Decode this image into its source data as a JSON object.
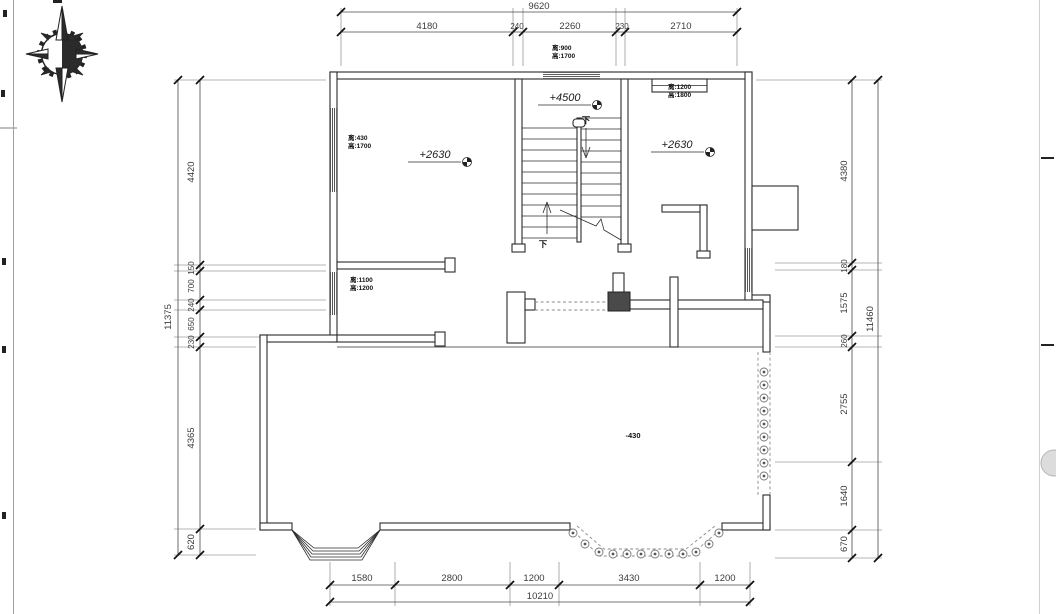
{
  "drawing": {
    "type": "architectural floor plan",
    "compass": "north-compass-rose"
  },
  "dimensions": {
    "top": {
      "total": "9620",
      "segments": [
        "4180",
        "240",
        "2260",
        "230",
        "2710"
      ]
    },
    "left": {
      "total": "11375",
      "segments": [
        "4420",
        "150",
        "700",
        "240",
        "650",
        "230",
        "4365",
        "620"
      ]
    },
    "right": {
      "total": "11460",
      "segments": [
        "4380",
        "180",
        "1575",
        "260",
        "2755",
        "1640",
        "670"
      ]
    },
    "bottom": {
      "total": "10210",
      "segments": [
        "1580",
        "2800",
        "1200",
        "3430",
        "1200"
      ]
    }
  },
  "elevation_markers": {
    "left_room": "+2630",
    "stair_hall": "+4500",
    "right_room": "+2630",
    "terrace": "-430"
  },
  "window_labels": {
    "top_wall": {
      "line1": "离:900",
      "line2": "高:1700"
    },
    "left_room": {
      "line1": "离:430",
      "line2": "高:1700"
    },
    "right_room": {
      "line1": "离:1200",
      "line2": "高:1800"
    },
    "left_corridor": {
      "line1": "离:1100",
      "line2": "高:1200"
    }
  },
  "stair": {
    "flight_up_label": "下",
    "flight_down_label": "下"
  },
  "colors": {
    "line": "#2b2b2b",
    "background": "#ffffff",
    "dashed": "#8a8a8a",
    "column_fill": "#4a4a4a"
  }
}
